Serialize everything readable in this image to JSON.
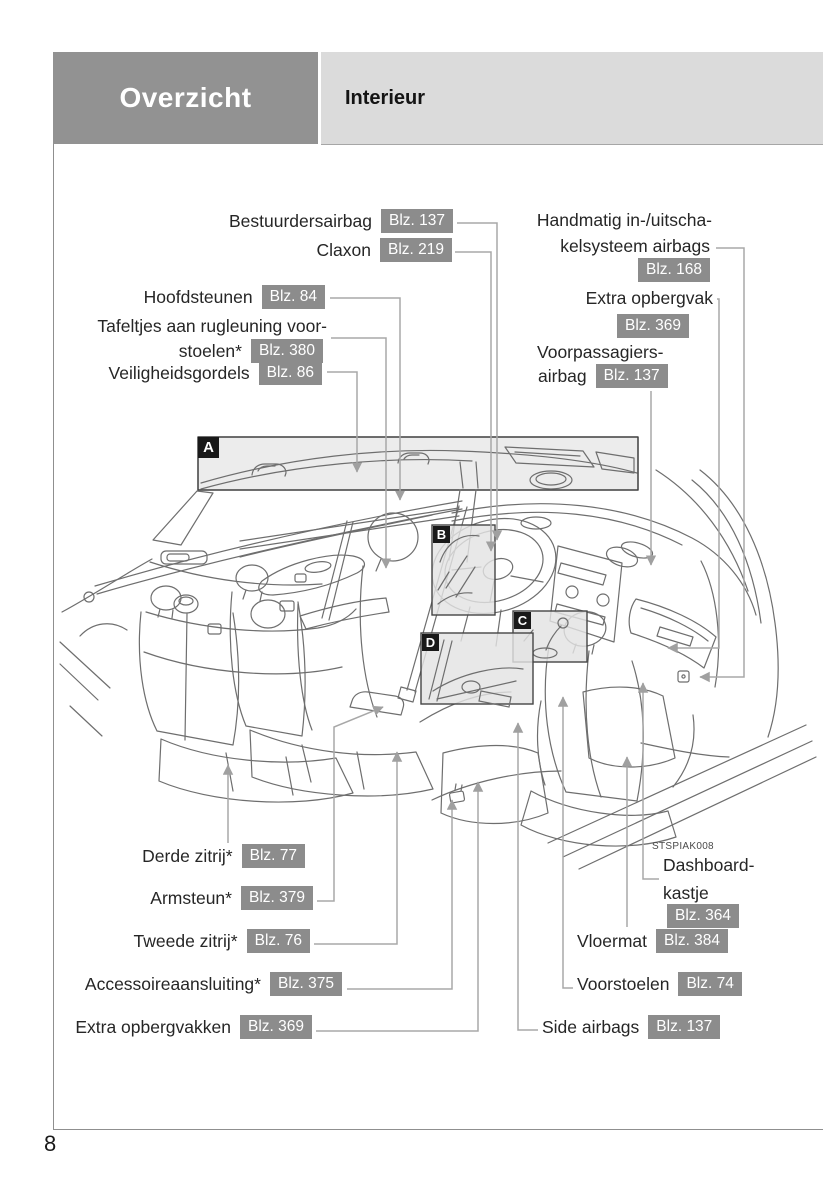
{
  "header": {
    "section_title": "Overzicht",
    "page_title": "Interieur"
  },
  "page_number": "8",
  "figure": {
    "code": "STSPIAK008",
    "regions": {
      "a": "A",
      "b": "B",
      "c": "C",
      "d": "D"
    }
  },
  "colors": {
    "header_dark": "#929292",
    "header_light": "#dbdbdb",
    "badge_bg": "#8c8c8c",
    "badge_text": "#ffffff",
    "letter_badge_bg": "#191919",
    "leader_line": "#a8a8a8",
    "art_line": "#6e6e6e"
  },
  "labels": {
    "bestuurdersairbag": {
      "text": "Bestuurdersairbag",
      "page": "Blz. 137"
    },
    "claxon": {
      "text": "Claxon",
      "page": "Blz. 219"
    },
    "hoofdsteunen": {
      "text": "Hoofdsteunen",
      "page": "Blz. 84"
    },
    "tafeltjes": {
      "line1": "Tafeltjes aan rugleuning voor-",
      "line2": "stoelen*",
      "page": "Blz. 380"
    },
    "veiligheidsgordels": {
      "text": "Veiligheidsgordels",
      "page": "Blz. 86"
    },
    "handmatig": {
      "line1": "Handmatig in-/uitscha-",
      "line2": "kelsysteem airbags",
      "page": "Blz. 168"
    },
    "extra_opbergvak": {
      "text": "Extra opbergvak",
      "page": "Blz. 369"
    },
    "voorpassagiers": {
      "line1": "Voorpassagiers-",
      "line2": "airbag",
      "page": "Blz. 137"
    },
    "derde_zitrij": {
      "text": "Derde zitrij*",
      "page": "Blz. 77"
    },
    "armsteun": {
      "text": "Armsteun*",
      "page": "Blz. 379"
    },
    "tweede_zitrij": {
      "text": "Tweede zitrij*",
      "page": "Blz. 76"
    },
    "accessoireaansluiting": {
      "text": "Accessoireaansluiting*",
      "page": "Blz. 375"
    },
    "extra_opbergvakken": {
      "text": "Extra opbergvakken",
      "page": "Blz. 369"
    },
    "dashboardkastje": {
      "line1": "Dashboard-",
      "line2": "kastje",
      "page": "Blz. 364"
    },
    "vloermat": {
      "text": "Vloermat",
      "page": "Blz. 384"
    },
    "voorstoelen": {
      "text": "Voorstoelen",
      "page": "Blz. 74"
    },
    "side_airbags": {
      "text": "Side airbags",
      "page": "Blz. 137"
    }
  }
}
